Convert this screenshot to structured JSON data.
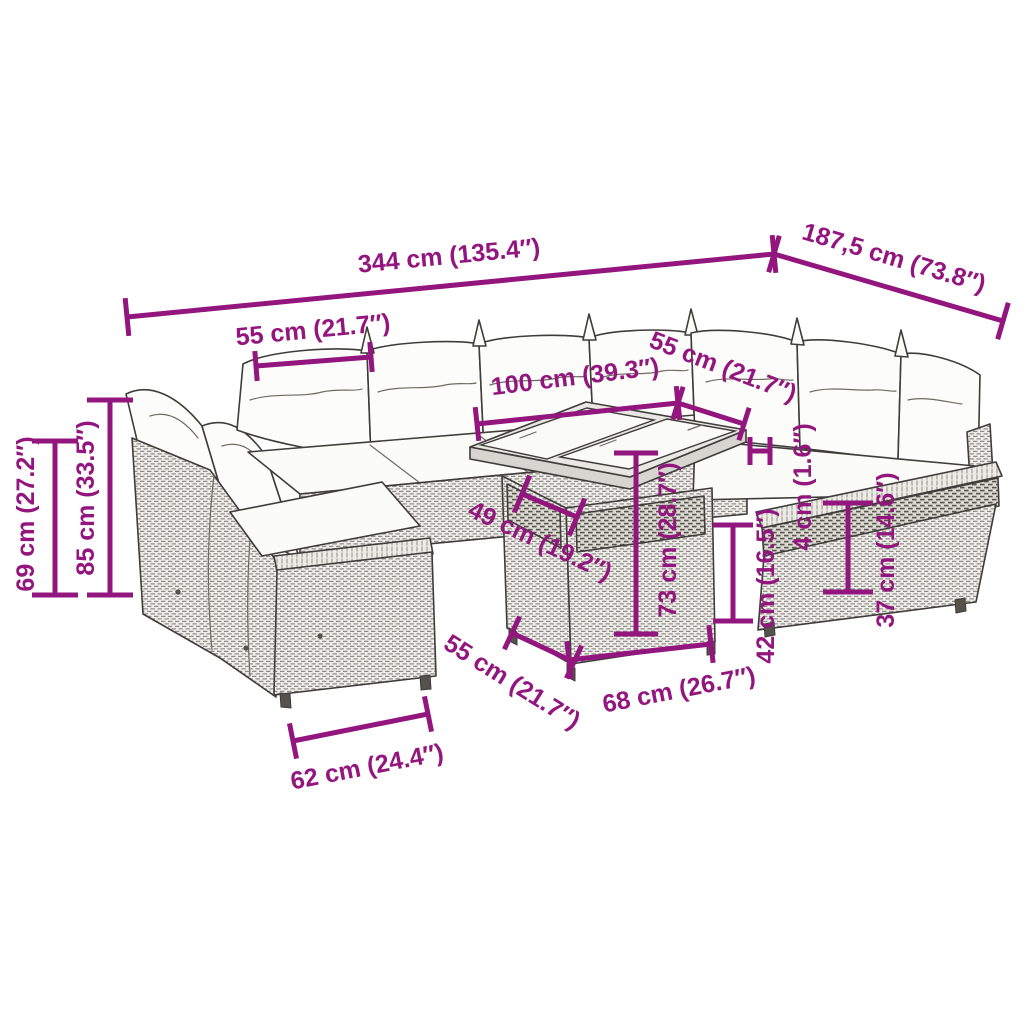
{
  "style": {
    "accent": "#93157E",
    "outline": "#3f3d3a",
    "background": "#ffffff",
    "dim_stroke": 5,
    "font_size": 25
  },
  "dimensions": [
    {
      "id": "overall-length",
      "label": "344 cm (135.4″)",
      "x1": 127,
      "y1": 317,
      "x2": 774,
      "y2": 254,
      "tick": 38,
      "lx": 449,
      "ly": 256,
      "rot": -5.5
    },
    {
      "id": "overall-depth",
      "label": "187,5 cm (73.8″)",
      "x1": 774,
      "y1": 254,
      "x2": 1003,
      "y2": 321,
      "tick": 38,
      "lx": 894,
      "ly": 258,
      "rot": 16.5
    },
    {
      "id": "seat-width-top",
      "label": "55 cm (21.7″)",
      "x1": 256,
      "y1": 366,
      "x2": 371,
      "y2": 357,
      "tick": 30,
      "lx": 313,
      "ly": 330,
      "rot": -5.5
    },
    {
      "id": "table-length",
      "label": "100 cm (39.3″)",
      "x1": 477,
      "y1": 424,
      "x2": 678,
      "y2": 403,
      "tick": 34,
      "lx": 575,
      "ly": 377,
      "rot": -7
    },
    {
      "id": "seat-width-right",
      "label": "55 cm (21.7″)",
      "x1": 678,
      "y1": 403,
      "x2": 744,
      "y2": 424,
      "tick": 34,
      "lx": 723,
      "ly": 367,
      "rot": 21
    },
    {
      "id": "seat-height",
      "label": "69 cm (27.2″)",
      "x1": 55,
      "y1": 441,
      "x2": 55,
      "y2": 595,
      "tick": 46,
      "lx": 26,
      "ly": 514,
      "rot": -90
    },
    {
      "id": "back-height",
      "label": "85 cm (33.5″)",
      "x1": 110,
      "y1": 400,
      "x2": 110,
      "y2": 595,
      "tick": 46,
      "lx": 86,
      "ly": 498,
      "rot": -90
    },
    {
      "id": "gap-width",
      "label": "49 cm (19.2″)",
      "x1": 522,
      "y1": 494,
      "x2": 577,
      "y2": 517,
      "tick": 40,
      "lx": 540,
      "ly": 541,
      "rot": 25
    },
    {
      "id": "table-height",
      "label": "73 cm (28.7″)",
      "x1": 636,
      "y1": 453,
      "x2": 636,
      "y2": 634,
      "tick": 44,
      "lx": 668,
      "ly": 540,
      "rot": -90
    },
    {
      "id": "seat-surface-height",
      "label": "42 cm (16.5″)",
      "x1": 733,
      "y1": 525,
      "x2": 733,
      "y2": 621,
      "tick": 40,
      "lx": 766,
      "ly": 586,
      "rot": -90
    },
    {
      "id": "top-thickness",
      "label": "4 cm (1.6″)",
      "x1": 750,
      "y1": 451,
      "x2": 770,
      "y2": 451,
      "tick": 28,
      "lx": 803,
      "ly": 487,
      "rot": -90
    },
    {
      "id": "base-height",
      "label": "37 cm (14.6″)",
      "x1": 848,
      "y1": 503,
      "x2": 848,
      "y2": 592,
      "tick": 50,
      "lx": 886,
      "ly": 550,
      "rot": -90
    },
    {
      "id": "table-depth",
      "label": "55 cm (21.7″)",
      "x1": 512,
      "y1": 633,
      "x2": 574,
      "y2": 662,
      "tick": 36,
      "lx": 512,
      "ly": 682,
      "rot": 32
    },
    {
      "id": "table-base-width",
      "label": "68 cm (26.7″)",
      "x1": 569,
      "y1": 660,
      "x2": 711,
      "y2": 644,
      "tick": 38,
      "lx": 679,
      "ly": 690,
      "rot": -11
    },
    {
      "id": "front-seat-depth",
      "label": "62 cm (24.4″)",
      "x1": 293,
      "y1": 741,
      "x2": 428,
      "y2": 714,
      "tick": 36,
      "lx": 367,
      "ly": 767,
      "rot": -11
    }
  ]
}
